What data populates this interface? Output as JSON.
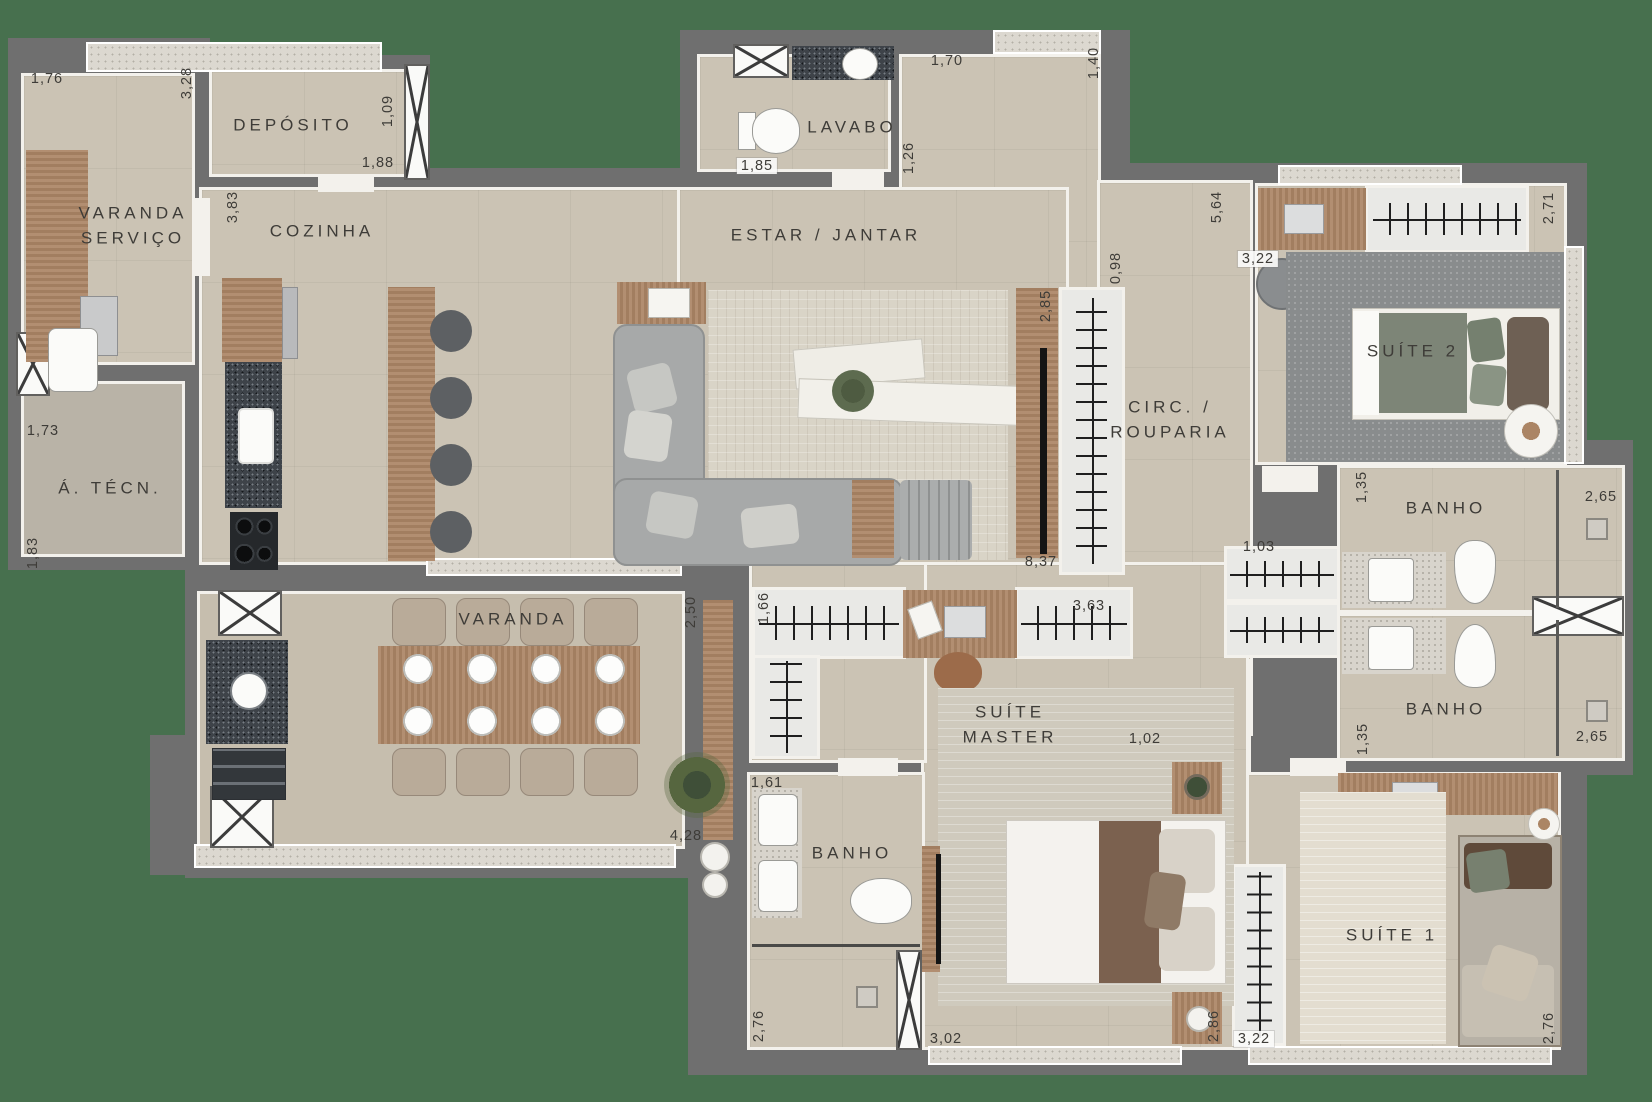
{
  "plan": {
    "colors": {
      "background": "#47704E",
      "wall": "#6F6F6F",
      "floor": "#CBC3B4",
      "wood": "#AB8565",
      "granite_counter": "#3E4349",
      "label_text": "#3E3C38"
    },
    "rooms": [
      {
        "label": "VARANDA\nSERVIÇO",
        "x": 133,
        "y": 226
      },
      {
        "label": "DEPÓSITO",
        "x": 293,
        "y": 126
      },
      {
        "label": "COZINHA",
        "x": 322,
        "y": 232
      },
      {
        "label": "LAVABO",
        "x": 852,
        "y": 128
      },
      {
        "label": "ESTAR / JANTAR",
        "x": 826,
        "y": 236
      },
      {
        "label": "Á. TÉCN.",
        "x": 110,
        "y": 489
      },
      {
        "label": "CIRC. /\nROUPARIA",
        "x": 1170,
        "y": 420
      },
      {
        "label": "SUÍTE 2",
        "x": 1413,
        "y": 352
      },
      {
        "label": "BANHO",
        "x": 1446,
        "y": 509
      },
      {
        "label": "BANHO",
        "x": 1446,
        "y": 710
      },
      {
        "label": "VARANDA",
        "x": 513,
        "y": 620
      },
      {
        "label": "SUÍTE\nMASTER",
        "x": 1010,
        "y": 725
      },
      {
        "label": "BANHO",
        "x": 852,
        "y": 854
      },
      {
        "label": "SUÍTE 1",
        "x": 1392,
        "y": 936
      }
    ],
    "dimensions": [
      {
        "value": "1,76",
        "x": 47,
        "y": 79,
        "vertical": false,
        "boxed": false
      },
      {
        "value": "3,28",
        "x": 187,
        "y": 83,
        "vertical": true,
        "boxed": false
      },
      {
        "value": "1,09",
        "x": 388,
        "y": 111,
        "vertical": true,
        "boxed": false
      },
      {
        "value": "1,88",
        "x": 378,
        "y": 163,
        "vertical": false,
        "boxed": false
      },
      {
        "value": "3,83",
        "x": 233,
        "y": 207,
        "vertical": true,
        "boxed": false
      },
      {
        "value": "1,85",
        "x": 757,
        "y": 166,
        "vertical": false,
        "boxed": true
      },
      {
        "value": "1,26",
        "x": 909,
        "y": 158,
        "vertical": true,
        "boxed": false
      },
      {
        "value": "1,70",
        "x": 947,
        "y": 61,
        "vertical": false,
        "boxed": false
      },
      {
        "value": "1,40",
        "x": 1094,
        "y": 63,
        "vertical": true,
        "boxed": false
      },
      {
        "value": "5,64",
        "x": 1217,
        "y": 207,
        "vertical": true,
        "boxed": false
      },
      {
        "value": "2,71",
        "x": 1549,
        "y": 208,
        "vertical": true,
        "boxed": false
      },
      {
        "value": "3,22",
        "x": 1258,
        "y": 259,
        "vertical": false,
        "boxed": true
      },
      {
        "value": "0,98",
        "x": 1116,
        "y": 268,
        "vertical": true,
        "boxed": false
      },
      {
        "value": "2,85",
        "x": 1046,
        "y": 306,
        "vertical": true,
        "boxed": false
      },
      {
        "value": "1,73",
        "x": 43,
        "y": 431,
        "vertical": false,
        "boxed": false
      },
      {
        "value": "1,83",
        "x": 33,
        "y": 553,
        "vertical": true,
        "boxed": false
      },
      {
        "value": "8,37",
        "x": 1041,
        "y": 562,
        "vertical": false,
        "boxed": false
      },
      {
        "value": "1,03",
        "x": 1259,
        "y": 547,
        "vertical": false,
        "boxed": false
      },
      {
        "value": "1,35",
        "x": 1362,
        "y": 487,
        "vertical": true,
        "boxed": false
      },
      {
        "value": "2,65",
        "x": 1601,
        "y": 497,
        "vertical": false,
        "boxed": false
      },
      {
        "value": "1,35",
        "x": 1363,
        "y": 739,
        "vertical": true,
        "boxed": false
      },
      {
        "value": "2,65",
        "x": 1592,
        "y": 737,
        "vertical": false,
        "boxed": false
      },
      {
        "value": "2,50",
        "x": 691,
        "y": 612,
        "vertical": true,
        "boxed": false
      },
      {
        "value": "1,66",
        "x": 764,
        "y": 608,
        "vertical": true,
        "boxed": false
      },
      {
        "value": "3,63",
        "x": 1089,
        "y": 606,
        "vertical": false,
        "boxed": false
      },
      {
        "value": "1,02",
        "x": 1145,
        "y": 739,
        "vertical": false,
        "boxed": false
      },
      {
        "value": "4,28",
        "x": 686,
        "y": 836,
        "vertical": false,
        "boxed": false
      },
      {
        "value": "1,61",
        "x": 767,
        "y": 783,
        "vertical": false,
        "boxed": false
      },
      {
        "value": "2,76",
        "x": 759,
        "y": 1026,
        "vertical": true,
        "boxed": false
      },
      {
        "value": "3,02",
        "x": 946,
        "y": 1039,
        "vertical": false,
        "boxed": false
      },
      {
        "value": "2,86",
        "x": 1214,
        "y": 1026,
        "vertical": true,
        "boxed": false
      },
      {
        "value": "3,22",
        "x": 1254,
        "y": 1039,
        "vertical": false,
        "boxed": true
      },
      {
        "value": "2,76",
        "x": 1549,
        "y": 1028,
        "vertical": true,
        "boxed": false
      }
    ]
  }
}
